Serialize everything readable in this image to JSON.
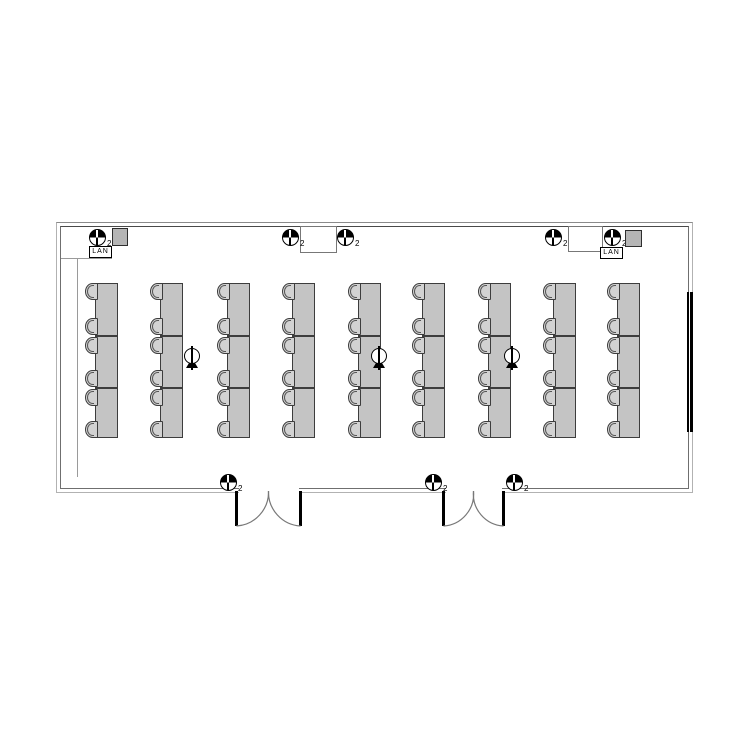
{
  "diagram": {
    "type": "floor-plan",
    "description": "Computer classroom floor plan: 9 desk banks of 3 tables with 6 chairs each, wall power/LAN outlets, floor outlets, two double doors, whiteboard on right wall"
  },
  "labels": {
    "lan": "LAN",
    "outlet_sub": "2"
  },
  "colors": {
    "desk_fill": "#c4c4c4",
    "desk_border": "#3d3d3d",
    "chair_fill": "#d2d2d2",
    "wall_outer": "#b2b2b2",
    "wall_inner": "#6f6f6f",
    "door": "#000000",
    "swing_arc": "#787878",
    "board": "#000000",
    "equipment": "#b5b5b5",
    "background": "#ffffff"
  },
  "room": {
    "outer": {
      "x": 56,
      "y": 222,
      "w": 637,
      "h": 271
    },
    "inner": {
      "x": 60,
      "y": 226,
      "w": 629,
      "h": 263
    },
    "step_h": {
      "x1": 61,
      "x2": 112,
      "y": 258
    },
    "step_v": {
      "x": 77,
      "y1": 258,
      "y2": 477
    }
  },
  "furniture": {
    "desk_top": 283,
    "desk_height": 155,
    "desk_width": 23,
    "sections_per_desk": 3,
    "desk_columns_x": [
      95,
      160,
      227,
      292,
      358,
      422,
      488,
      553,
      617
    ],
    "divider_offsets": [
      51,
      103
    ],
    "chair_y_offsets": [
      0,
      34.5,
      53.5,
      86.5,
      105.5,
      138
    ],
    "chair_w": 13,
    "chair_h": 17
  },
  "fixtures": {
    "wall_outlets": [
      {
        "x": 97,
        "y": 237
      },
      {
        "x": 290,
        "y": 237
      },
      {
        "x": 345,
        "y": 237
      },
      {
        "x": 553,
        "y": 237
      },
      {
        "x": 612,
        "y": 237
      },
      {
        "x": 228,
        "y": 482
      },
      {
        "x": 433,
        "y": 482
      },
      {
        "x": 514,
        "y": 482
      }
    ],
    "floor_outlets": [
      {
        "x": 192,
        "y": 357
      },
      {
        "x": 379,
        "y": 357
      },
      {
        "x": 512,
        "y": 357
      }
    ],
    "lan_boxes": [
      {
        "x": 89,
        "y": 246,
        "w": 23,
        "h": 12
      },
      {
        "x": 600,
        "y": 247,
        "w": 23,
        "h": 12
      }
    ],
    "equipment_boxes": [
      {
        "x": 112,
        "y": 228,
        "w": 16,
        "h": 18
      },
      {
        "x": 625,
        "y": 230,
        "w": 17,
        "h": 17
      }
    ],
    "pillars": [
      {
        "x": 300,
        "y": 226,
        "w": 37,
        "h": 27
      },
      {
        "x": 568,
        "y": 226,
        "w": 35,
        "h": 26
      }
    ],
    "doors": [
      {
        "left": 236.5,
        "right": 300.5,
        "top": 491,
        "leaf_len": 35
      },
      {
        "left": 443.5,
        "right": 503.5,
        "top": 491,
        "leaf_len": 35
      }
    ],
    "whiteboard": {
      "x": 687,
      "y": 292,
      "w": 6,
      "h": 140
    }
  }
}
